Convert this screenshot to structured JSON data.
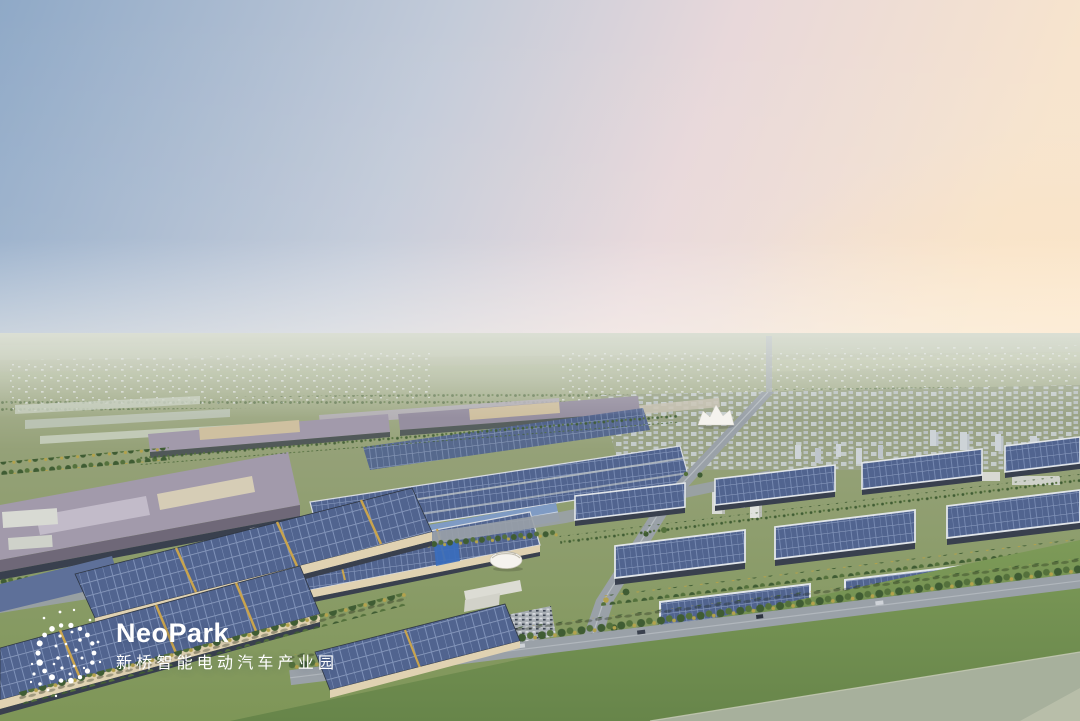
{
  "scene": {
    "alt": "Aerial 3D rendering of an electric-vehicle industrial park: large factory halls and warehouses covered with rooftop solar panels, tree-lined roads, a white tent landmark, a residential city and green fields stretching to the horizon under a clear dawn sky",
    "landmarks": [
      "solar-roof-factories",
      "warehouse-grid",
      "exhibition-tent",
      "residential-city",
      "main-avenue",
      "lawn",
      "distant-fields"
    ]
  },
  "logo": {
    "brand": "NeoPark",
    "subtitle": "新桥智能电动汽车产业园",
    "mark": "dot-globe-icon"
  },
  "palette": {
    "sky_top": "#8FA9C7",
    "sky_mid": "#C3CBD9",
    "sky_pink": "#E8D8DA",
    "sky_peach": "#F7E4CD",
    "sky_glow": "#FCE2BE",
    "field_far": "#BCC2AB",
    "field_mid": "#95A178",
    "field_green": "#7E9657",
    "lawn": "#7D9A58",
    "lawn_dark": "#67854A",
    "distant_struct": "#DCE0DC",
    "city_base": "#9AA386",
    "city_block_a": "#CDD3D7",
    "city_block_b": "#BEC5CB",
    "pv_base": "#51648F",
    "pv_line": "#7E91B8",
    "pv_light": "#93A3C5",
    "roof_grey": "#A29AAB",
    "roof_grey_light": "#C2BBC9",
    "roof_tan": "#CFC0A0",
    "wall_cream": "#E0D2B2",
    "wall_dark": "#39404E",
    "road": "#9AA1A8",
    "road_light": "#C2C7CC",
    "tree_dark": "#3F5C33",
    "tree_mid": "#54713C",
    "tree_yellow": "#B3A24C",
    "tent_white": "#F5F3EE",
    "glass_blue": "#3A6DBD",
    "pad_grey": "#A7B09C",
    "pad_light": "#B8BEA9",
    "gold": "#C9A44E",
    "logo_white": "#FFFFFF"
  }
}
